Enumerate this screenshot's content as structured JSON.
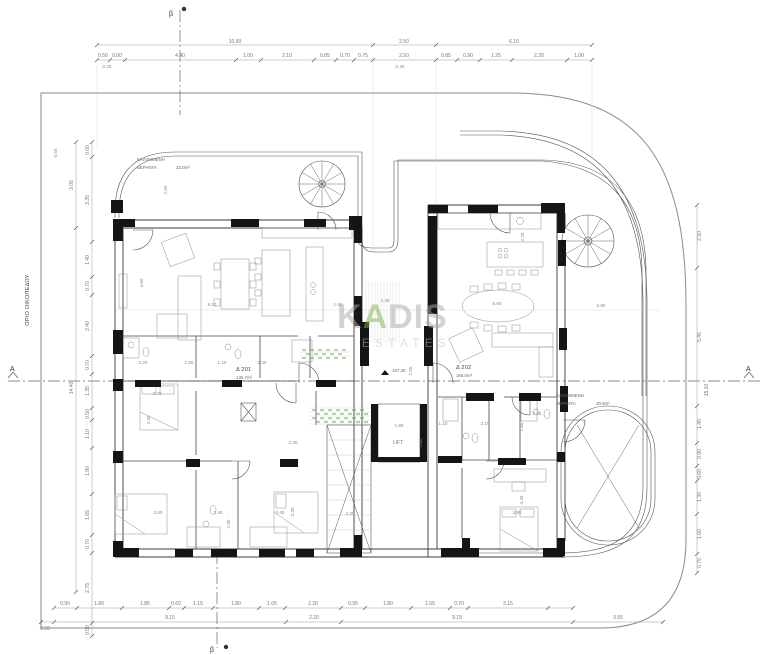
{
  "boundary": {
    "label": "ΟΡΙΟ ΟΙΚΟΠΕΔΟΥ"
  },
  "markers": {
    "section_top": "β",
    "section_bottom": "β",
    "section_left": "A",
    "section_right": "A",
    "level": "167.30"
  },
  "core": {
    "lift": "LIFT"
  },
  "units": {
    "unit1": {
      "name": "Δ 201",
      "area": "136.7m²"
    },
    "unit2": {
      "name": "Δ 202",
      "area": "166.0m²"
    },
    "veranda1": {
      "line1": "ΚΑΛΥΜΜΕΝΗ",
      "line2": "ΒΕΡΑΝΤΑ",
      "area": "32.0m²"
    },
    "veranda2": {
      "line1": "ΚΑΛΥΜΜΕΝΗ",
      "line2": "ΒΕΡΑΝΤΑ",
      "area": "30.8m²"
    }
  },
  "watermark": {
    "part1": "K",
    "accent": "A",
    "part2": "DIS",
    "sub": "ESTATES",
    "accent_color": "#7ab648",
    "text_color": "#a8a8a8",
    "sub_color": "#bdbdbd"
  },
  "colors": {
    "walls": "#151515",
    "linework": "#444444",
    "dimension_text": "#757575",
    "planting": "#6aa84f",
    "background": "#ffffff"
  },
  "dims": {
    "top1": [
      "10.90",
      "2.50",
      "6.10"
    ],
    "top2": [
      "0.50",
      "0.60",
      "4.40",
      "1.00",
      "2.10",
      "0.85",
      "0.70",
      "0.75",
      "2.50",
      "0.85",
      "0.90",
      "1.25",
      "2.20",
      "1.00"
    ],
    "top_sub": [
      "0.25",
      "0.25"
    ],
    "bottom1": [
      "0.90",
      "1.80",
      "1.85",
      "0.60",
      "1.15",
      "1.80",
      "1.05",
      "2.20",
      "0.95",
      "1.80",
      "1.55",
      "0.70",
      "3.15"
    ],
    "bottom2": [
      "0.50",
      "9.15",
      "2.20",
      "9.15",
      "3.55"
    ],
    "left_inner": [
      "0.60",
      "3.35",
      "1.40",
      "0.70",
      "2.40",
      "0.70",
      "1.35",
      "0.50",
      "1.10",
      "1.80",
      "1.65",
      "0.70",
      "2.75",
      "0.50"
    ],
    "left_outer": [
      "3.05",
      "14.40"
    ],
    "right_inner": [
      "2.50",
      "5.45",
      "1.45",
      "0.90",
      "0.60",
      "1.30",
      "1.60",
      "0.75"
    ],
    "right_outer": [
      "15.10"
    ],
    "interior": [
      "4.60",
      "8.10",
      "1.90",
      "2.20",
      "1.50",
      "1.10",
      "2.30",
      "3.20",
      "3.30",
      "3.50",
      "1.40",
      "2.30",
      "3.40",
      "3.30",
      "2.20",
      "2.30",
      "2.25",
      "5.60",
      "2.90",
      "1.10",
      "2.15",
      "1.65",
      "2.15",
      "4.45",
      "3.80",
      "1.80",
      "1.60",
      "2.55",
      "2.50",
      "0.50",
      "4.40"
    ]
  }
}
